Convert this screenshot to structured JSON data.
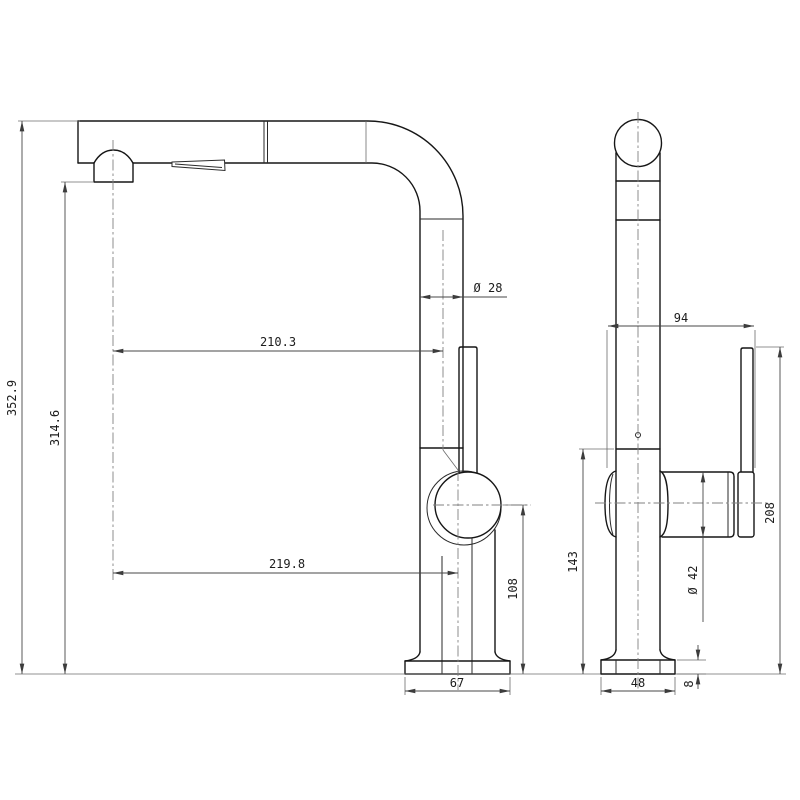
{
  "drawing": {
    "type": "technical-orthographic-drawing",
    "subject": "pull-out kitchen faucet",
    "units": "mm",
    "views": {
      "side": {
        "label": "side-view",
        "dimensions": {
          "overall_height": "352.9",
          "spout_outlet_height": "314.6",
          "spout_reach_upper": "210.3",
          "spout_reach_lower": "219.8",
          "spout_tube_diameter": "Ø 28",
          "handle_center_height": "108",
          "base_length": "67"
        }
      },
      "front": {
        "label": "front-view",
        "dimensions": {
          "handle_span": "94",
          "lever_top_height": "208",
          "body_joint_height": "143",
          "handle_diameter": "Ø 42",
          "base_width": "48",
          "base_plate_thickness": "8"
        }
      }
    },
    "colors": {
      "background": "#ffffff",
      "outline": "#161616",
      "dimension_lines": "#474747",
      "centerlines": "#828282"
    }
  }
}
